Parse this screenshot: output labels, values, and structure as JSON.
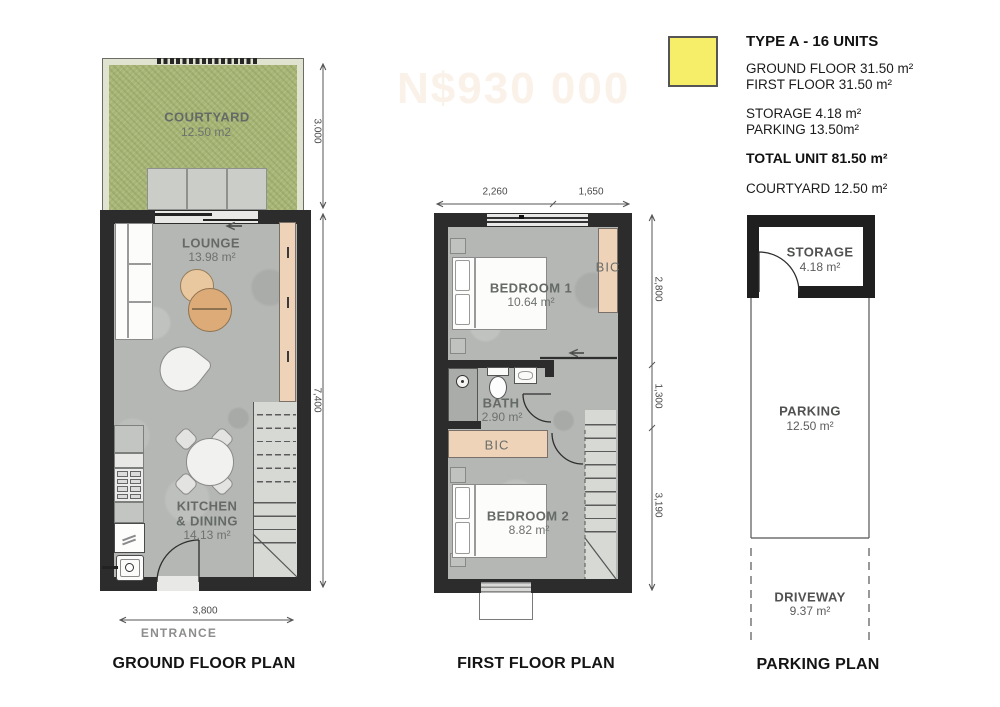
{
  "sheet": {
    "watermark": "N$930 000"
  },
  "palette": {
    "legend_swatch": "#F6ED68",
    "wall": "#2C2C2C",
    "concrete": "#B4B7B3",
    "grass": "#A9B679",
    "wood": "#EED3B8"
  },
  "legend": {
    "title": "TYPE A - 16 UNITS",
    "ground_floor": "GROUND FLOOR 31.50 m²",
    "first_floor": "FIRST FLOOR 31.50 m²",
    "storage": "STORAGE 4.18 m²",
    "parking": "PARKING 13.50m²",
    "total": "TOTAL UNIT 81.50 m²",
    "courtyard": "COURTYARD 12.50 m²"
  },
  "ground_floor": {
    "title": "GROUND FLOOR PLAN",
    "entrance": "ENTRANCE",
    "courtyard": {
      "name": "COURTYARD",
      "area": "12.50 m2"
    },
    "lounge": {
      "name": "LOUNGE",
      "area": "13.98 m²"
    },
    "kitchen": {
      "line1": "KITCHEN",
      "line2": "& DINING",
      "area": "14.13 m²"
    },
    "dims": {
      "width": "3,800",
      "courtyard_depth": "3.000",
      "depth": "7,400"
    }
  },
  "first_floor": {
    "title": "FIRST FLOOR PLAN",
    "bedroom1": {
      "name": "BEDROOM 1",
      "area": "10.64 m²"
    },
    "bath": {
      "name": "BATH",
      "area": "2.90 m²"
    },
    "bedroom2": {
      "name": "BEDROOM 2",
      "area": "8.82 m²"
    },
    "bic_upper": "BIC",
    "bic_lower": "BIC",
    "dims": {
      "top_left": "2,260",
      "top_right": "1,650",
      "right_top": "2,800",
      "right_mid": "1,300",
      "right_bottom": "3,190"
    }
  },
  "parking_plan": {
    "title": "PARKING PLAN",
    "storage": {
      "name": "STORAGE",
      "area": "4.18 m²"
    },
    "parking": {
      "name": "PARKING",
      "area": "12.50 m²"
    },
    "driveway": {
      "name": "DRIVEWAY",
      "area": "9.37 m²"
    }
  }
}
